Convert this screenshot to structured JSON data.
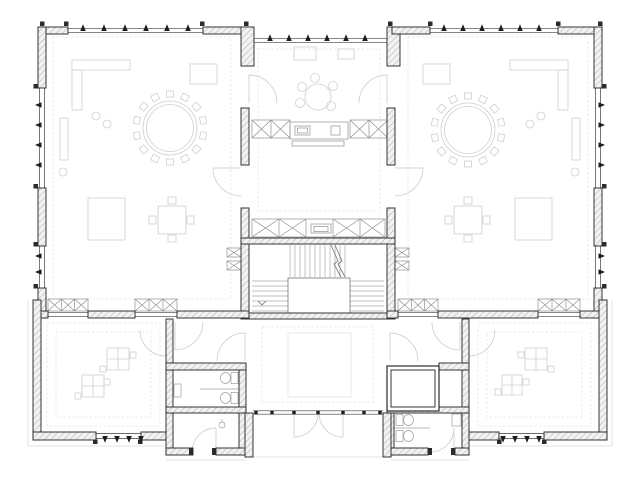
{
  "drawing": {
    "kind": "architectural floor plan",
    "view": "top-down ground-floor plan, monochrome CAD line drawing",
    "text_labels": []
  },
  "colors": {
    "background": "#ffffff",
    "wall_line": "#2b2b2b",
    "hatch_line": "#a9aeb1",
    "hatch_fill": "#f1f2f3",
    "window_line": "#3d3d3d",
    "mullion": "#1d1d1d",
    "furniture": "#ccd0d2",
    "casework": "#8d9296",
    "fixture": "#9aa0a3",
    "stair_line": "#a6aaad",
    "stair_edge": "#6f7477",
    "door_line": "#c2c6c8",
    "floor_pattern": "#e0e2e3",
    "eaves": "#d8dadb",
    "landing_fill": "#ffffff"
  },
  "building": {
    "rooms": [
      {
        "name": "group-room-left",
        "contents": [
          "large round table with ring of chairs",
          "wall shelving",
          "desk",
          "cabinet",
          "square table with four chairs",
          "window benches"
        ]
      },
      {
        "name": "group-room-right",
        "contents": [
          "large round table with ring of chairs",
          "wall shelving",
          "desk",
          "cabinet",
          "square table with four chairs",
          "window benches"
        ]
      },
      {
        "name": "kitchen-dining",
        "contents": [
          "small round table with five chairs",
          "kitchen counters with sink",
          "cabinets"
        ]
      },
      {
        "name": "corridor",
        "contents": [
          "built-in cabinet row with washbasin"
        ]
      },
      {
        "name": "stair-hall",
        "contents": [
          "three-flight dog-leg stair",
          "central landing",
          "direction arrow"
        ]
      },
      {
        "name": "entrance-hall",
        "contents": [
          "floor mat",
          "double entry door",
          "recessed porch"
        ]
      },
      {
        "name": "playroom-left",
        "contents": [
          "two square play tables",
          "dashed floor border"
        ]
      },
      {
        "name": "playroom-right",
        "contents": [
          "two square play tables",
          "dashed floor border"
        ]
      },
      {
        "name": "wc-left",
        "contents": [
          "two toilet stalls",
          "washbasin",
          "utility room"
        ]
      },
      {
        "name": "wc-right",
        "contents": [
          "two toilet stalls",
          "washbasin"
        ]
      },
      {
        "name": "elevator",
        "contents": [
          "lift shaft with cab"
        ]
      }
    ],
    "envelope": {
      "wall_style": "hatched masonry piers",
      "window_style": "strip windows with mullion tick marks",
      "mullion_counts": {
        "top_left": 6,
        "top_center": 6,
        "top_right": 6,
        "left_wall": 6,
        "right_wall": 6,
        "wing_left_bottom": 4,
        "wing_right_bottom": 4,
        "entrance_front": 7
      }
    }
  }
}
